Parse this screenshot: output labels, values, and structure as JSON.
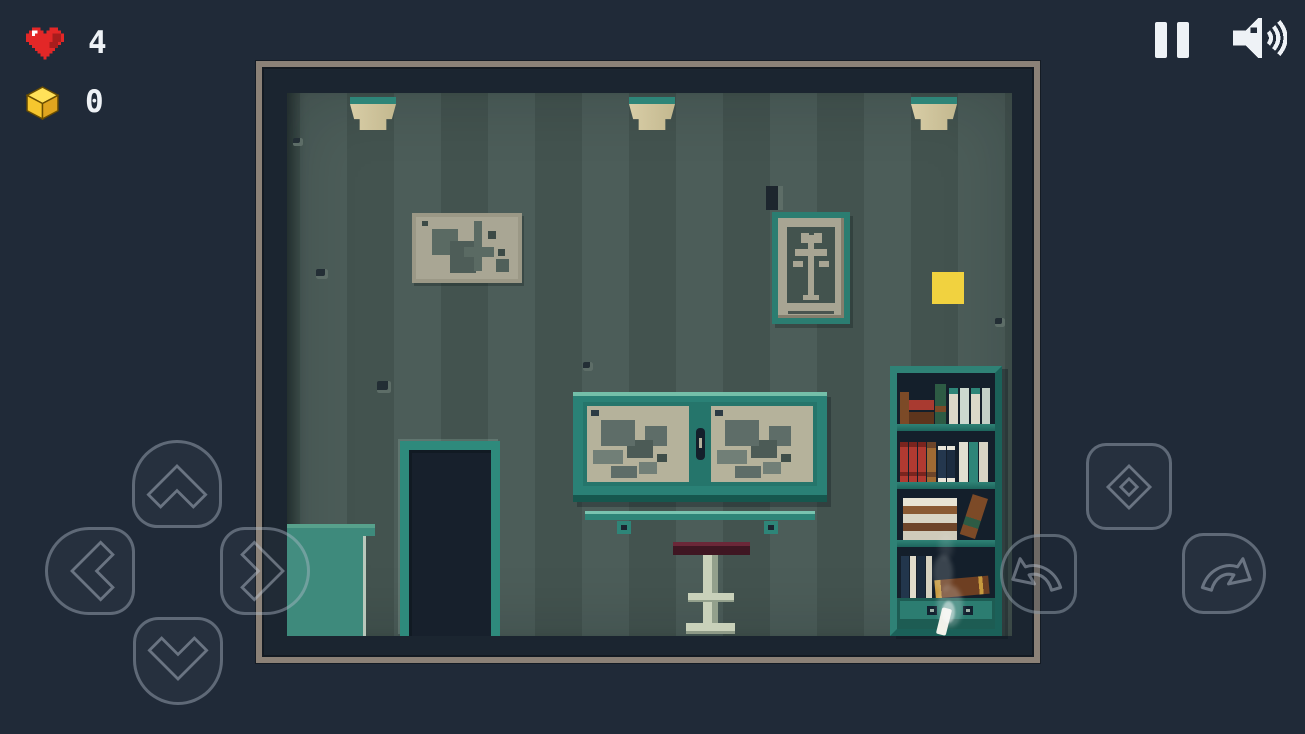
{
  "hud": {
    "lives": {
      "icon": "heart-icon",
      "value": "4"
    },
    "cubes": {
      "icon": "cube-icon",
      "value": "0"
    }
  },
  "topbar": {
    "pause": {
      "icon": "pause-icon",
      "label": "pause"
    },
    "volume": {
      "icon": "speaker-icon",
      "label": "sound"
    }
  },
  "controls": {
    "up": {
      "icon": "chevron-up-icon",
      "label": "up"
    },
    "down": {
      "icon": "chevron-down-icon",
      "label": "down"
    },
    "left": {
      "icon": "chevron-left-icon",
      "label": "left"
    },
    "right": {
      "icon": "chevron-right-icon",
      "label": "right"
    },
    "interact": {
      "icon": "diamond-icon",
      "label": "interact"
    },
    "undo": {
      "icon": "curved-arrow-left-icon",
      "label": "undo"
    },
    "redo": {
      "icon": "curved-arrow-right-icon",
      "label": "redo"
    }
  },
  "scene": {
    "collectible": "yellow-cube",
    "objects": [
      "ceiling-lamp",
      "map-picture",
      "portrait-picture",
      "wall-hook",
      "wall-cabinet",
      "coat-rail",
      "rail-hook",
      "stool",
      "door",
      "side-cabinet",
      "bookshelf",
      "drawer",
      "cigarette",
      "smoke",
      "wall-speck"
    ]
  },
  "colors": {
    "background": "#202a38",
    "text": "#eef2f6",
    "frame_border": "#8b8177",
    "frame_inner": "#1b2530",
    "wall_light": "#4c5d59",
    "wall_dark": "#43534f",
    "teal": "#2e8578",
    "teal_bright": "#74bfa9",
    "teal_dark": "#1b6159",
    "glass": "#b5b29b",
    "cube_yellow": "#f1d23f",
    "heart_red": "#e32727",
    "hud_cube_gold": "#f6c62e",
    "button_outline": "rgba(174,186,199,0.42)",
    "button_fill": "rgba(233,240,248,0.03)"
  }
}
